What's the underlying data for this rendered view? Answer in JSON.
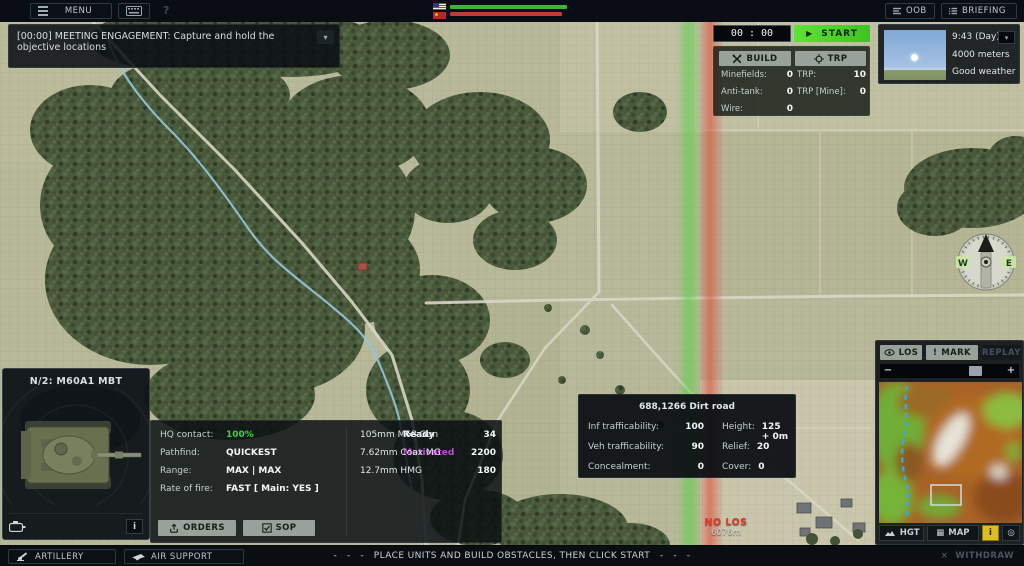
{
  "topbar": {
    "menu_label": "MENU",
    "help_label": "?",
    "oob_label": "OOB",
    "briefing_label": "BRIEFING"
  },
  "objective_banner": {
    "text": "[00:00] MEETING ENGAGEMENT: Capture and hold the objective locations"
  },
  "match_control": {
    "timer": "00 : 00",
    "start_label": "START",
    "build_label": "BUILD",
    "trp_label": "TRP",
    "build_stats": [
      {
        "label": "Minefields:",
        "value": "0"
      },
      {
        "label": "Anti-tank:",
        "value": "0"
      },
      {
        "label": "Wire:",
        "value": "0"
      }
    ],
    "trp_stats": [
      {
        "label": "TRP:",
        "value": "10"
      },
      {
        "label": "TRP [Mine]:",
        "value": "0"
      }
    ]
  },
  "weather": {
    "time": "9:43 (Day)",
    "visibility": "4000 meters",
    "condition": "Good weather"
  },
  "compass": {
    "west": "W",
    "east": "E"
  },
  "minimap_panel": {
    "los_label": "LOS",
    "mark_label": "MARK",
    "replay_label": "REPLAY",
    "hgt_label": "HGT",
    "map_label": "MAP",
    "info_label": "i"
  },
  "unit_panel": {
    "title": "N/2: M60A1 MBT",
    "info_label": "i",
    "stats": [
      {
        "label": "HQ contact:",
        "value": "100%"
      },
      {
        "label": "Pathfind:",
        "value": "QUICKEST"
      },
      {
        "label": "Range:",
        "value": "MAX | MAX"
      },
      {
        "label": "Rate of fire:",
        "value": "FAST [ Main: YES ]"
      }
    ],
    "status": {
      "readiness": "Ready",
      "morale": "Motivated"
    },
    "weapons": [
      {
        "name": "105mm M68 Gun",
        "ammo": "34"
      },
      {
        "name": "7.62mm Coax MG",
        "ammo": "2200"
      },
      {
        "name": "12.7mm HMG",
        "ammo": "180"
      }
    ],
    "orders_label": "ORDERS",
    "sop_label": "SOP"
  },
  "terrain_tooltip": {
    "title": "688,1266 Dirt road",
    "left": [
      {
        "label": "Inf trafficability:",
        "value": "100"
      },
      {
        "label": "Veh trafficability:",
        "value": "90"
      },
      {
        "label": "Concealment:",
        "value": "0"
      }
    ],
    "right": [
      {
        "label": "Height:",
        "value": "125 + 0m"
      },
      {
        "label": "Relief:",
        "value": "20"
      },
      {
        "label": "Cover:",
        "value": "0"
      }
    ]
  },
  "los_readout": {
    "status": "NO LOS",
    "distance": "6076m"
  },
  "bottombar": {
    "artillery_label": "ARTILLERY",
    "air_support_label": "AIR SUPPORT",
    "status_message": "-   -   -   PLACE UNITS AND BUILD OBSTACLES, THEN CLICK START   -   -   -",
    "withdraw_label": "WITHDRAW"
  },
  "icons": {
    "play": "▶",
    "chevron_down": "▾",
    "map_grid": "▦",
    "recenter": "◎",
    "zoom_out": "−",
    "zoom_in": "+",
    "mark": "!",
    "close": "×"
  },
  "colors": {
    "accent_green": "#52d42e",
    "hq_contact_green": "#3ed43e",
    "morale_magenta": "#bb4fd0",
    "no_los_red": "#e23a2e",
    "info_yellow": "#dcbe22",
    "friendly_zone_green": "#4fd43a",
    "enemy_zone_red": "#e04838",
    "friendly_bar": "#3fb33c",
    "enemy_bar": "#c23b33"
  }
}
